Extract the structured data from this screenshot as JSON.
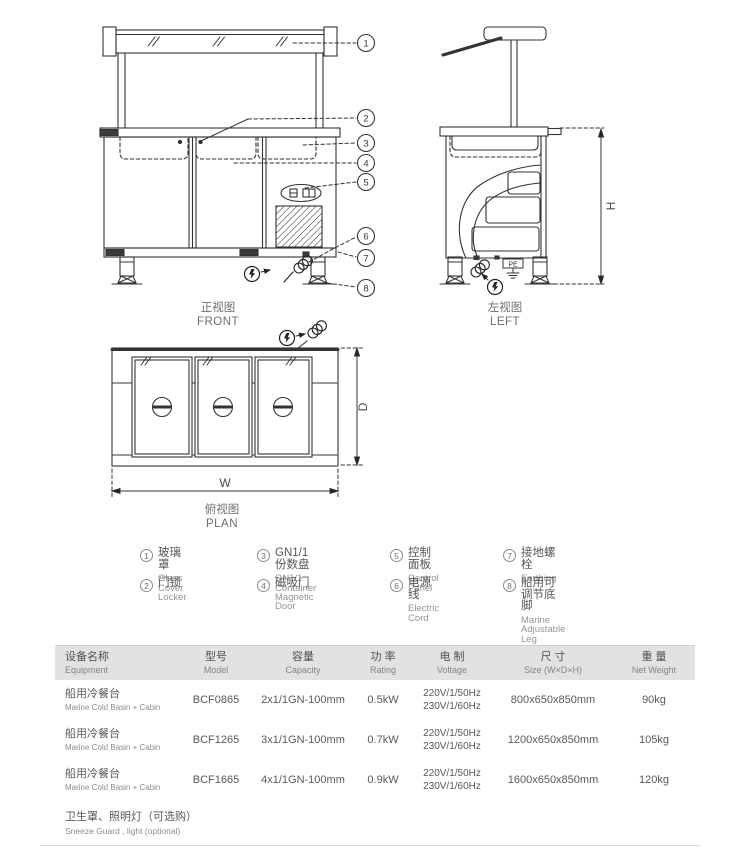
{
  "drawings": {
    "front": {
      "title_zh": "正视图",
      "title_en": "FRONT"
    },
    "left": {
      "title_zh": "左视图",
      "title_en": "LEFT"
    },
    "plan": {
      "title_zh": "俯视图",
      "title_en": "PLAN"
    },
    "dims": {
      "height": "H",
      "width": "W",
      "depth": "D"
    },
    "pe": "PE"
  },
  "legend": {
    "items": [
      {
        "num": "1",
        "zh": "玻璃罩",
        "en": "Glass Cover"
      },
      {
        "num": "2",
        "zh": "门锁",
        "en": "Locker"
      },
      {
        "num": "3",
        "zh": "GN1/1 份数盘",
        "en": "GN1/1 Container"
      },
      {
        "num": "4",
        "zh": "磁吸门",
        "en": "Magnetic Door"
      },
      {
        "num": "5",
        "zh": "控制面板",
        "en": "Control Panel"
      },
      {
        "num": "6",
        "zh": "电源线",
        "en": "Electric Cord"
      },
      {
        "num": "7",
        "zh": "接地螺栓",
        "en": "Earthing"
      },
      {
        "num": "8",
        "zh": "船用可调节底脚",
        "en": "Marine Adjustable Leg"
      }
    ]
  },
  "table": {
    "headers": [
      {
        "zh": "设备名称",
        "en": "Equipment"
      },
      {
        "zh": "型号",
        "en": "Model"
      },
      {
        "zh": "容量",
        "en": "Capacity"
      },
      {
        "zh": "功 率",
        "en": "Rating"
      },
      {
        "zh": "电 制",
        "en": "Voltage"
      },
      {
        "zh": "尺 寸",
        "en": "Size (W×D×H)"
      },
      {
        "zh": "重 量",
        "en": "Net Weight"
      }
    ],
    "rows": [
      {
        "name_zh": "船用冷餐台",
        "name_en": "Marine Cold Basin + Cabin",
        "model": "BCF0865",
        "capacity": "2x1/1GN-100mm",
        "rating": "0.5kW",
        "voltage1": "220V/1/50Hz",
        "voltage2": "230V/1/60Hz",
        "size": "800x650x850mm",
        "weight": "90kg"
      },
      {
        "name_zh": "船用冷餐台",
        "name_en": "Marine Cold Basin + Cabin",
        "model": "BCF1265",
        "capacity": "3x1/1GN-100mm",
        "rating": "0.7kW",
        "voltage1": "220V/1/50Hz",
        "voltage2": "230V/1/60Hz",
        "size": "1200x650x850mm",
        "weight": "105kg"
      },
      {
        "name_zh": "船用冷餐台",
        "name_en": "Marine Cold Basin + Cabin",
        "model": "BCF1665",
        "capacity": "4x1/1GN-100mm",
        "rating": "0.9kW",
        "voltage1": "220V/1/50Hz",
        "voltage2": "230V/1/60Hz",
        "size": "1600x650x850mm",
        "weight": "120kg"
      }
    ],
    "footer": {
      "zh": "卫生罩、照明灯（可选购）",
      "en": "Sneeze Guard , light (optional)"
    }
  },
  "colors": {
    "line": "#333333",
    "label_gray": "#6d6e71",
    "header_bg": "#e2e2e2",
    "rule": "#d8d8d8"
  }
}
